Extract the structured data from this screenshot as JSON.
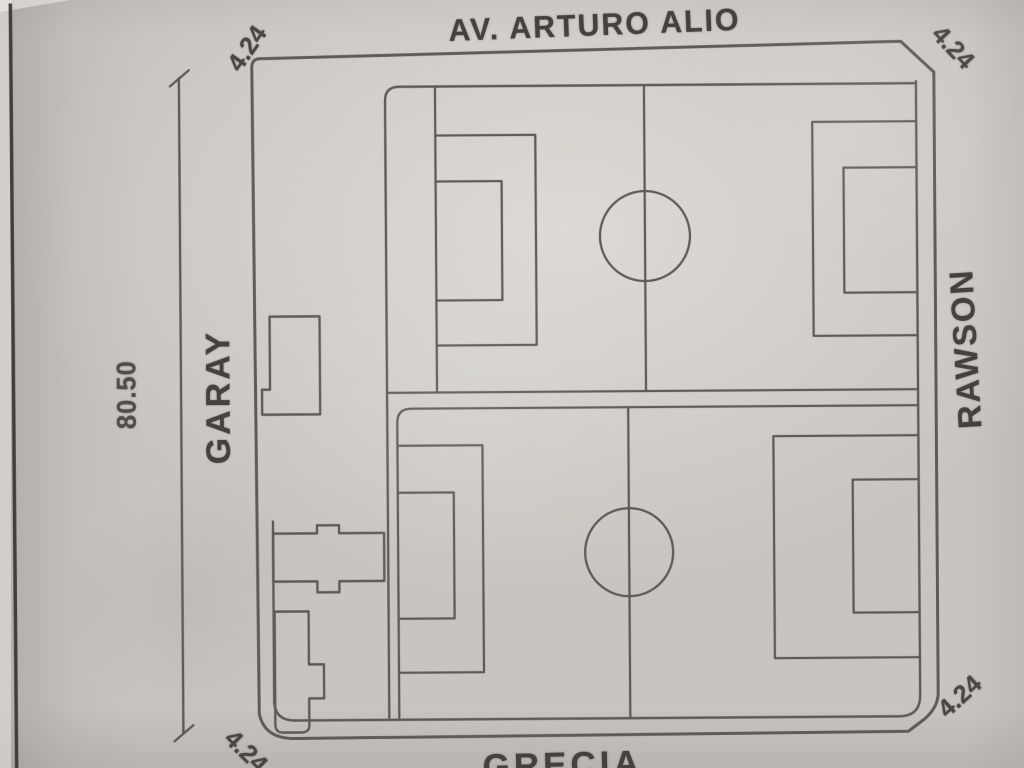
{
  "plan": {
    "streets": {
      "top": "AV. ARTURO ALIO",
      "left": "GARAY",
      "right": "RAWSON",
      "bottom": "GRECIA"
    },
    "dimensions": {
      "left_side_length": "80.50",
      "chamfer_top_left": "4.24",
      "chamfer_top_right": "4.24",
      "chamfer_bottom_left": "4.24",
      "chamfer_bottom_right": "4.24"
    }
  },
  "colors": {
    "paper": "#c8c4bf",
    "ink_lines": "#5a5550",
    "ink_text": "#45413d",
    "page_edge_line": "#3c3936"
  }
}
